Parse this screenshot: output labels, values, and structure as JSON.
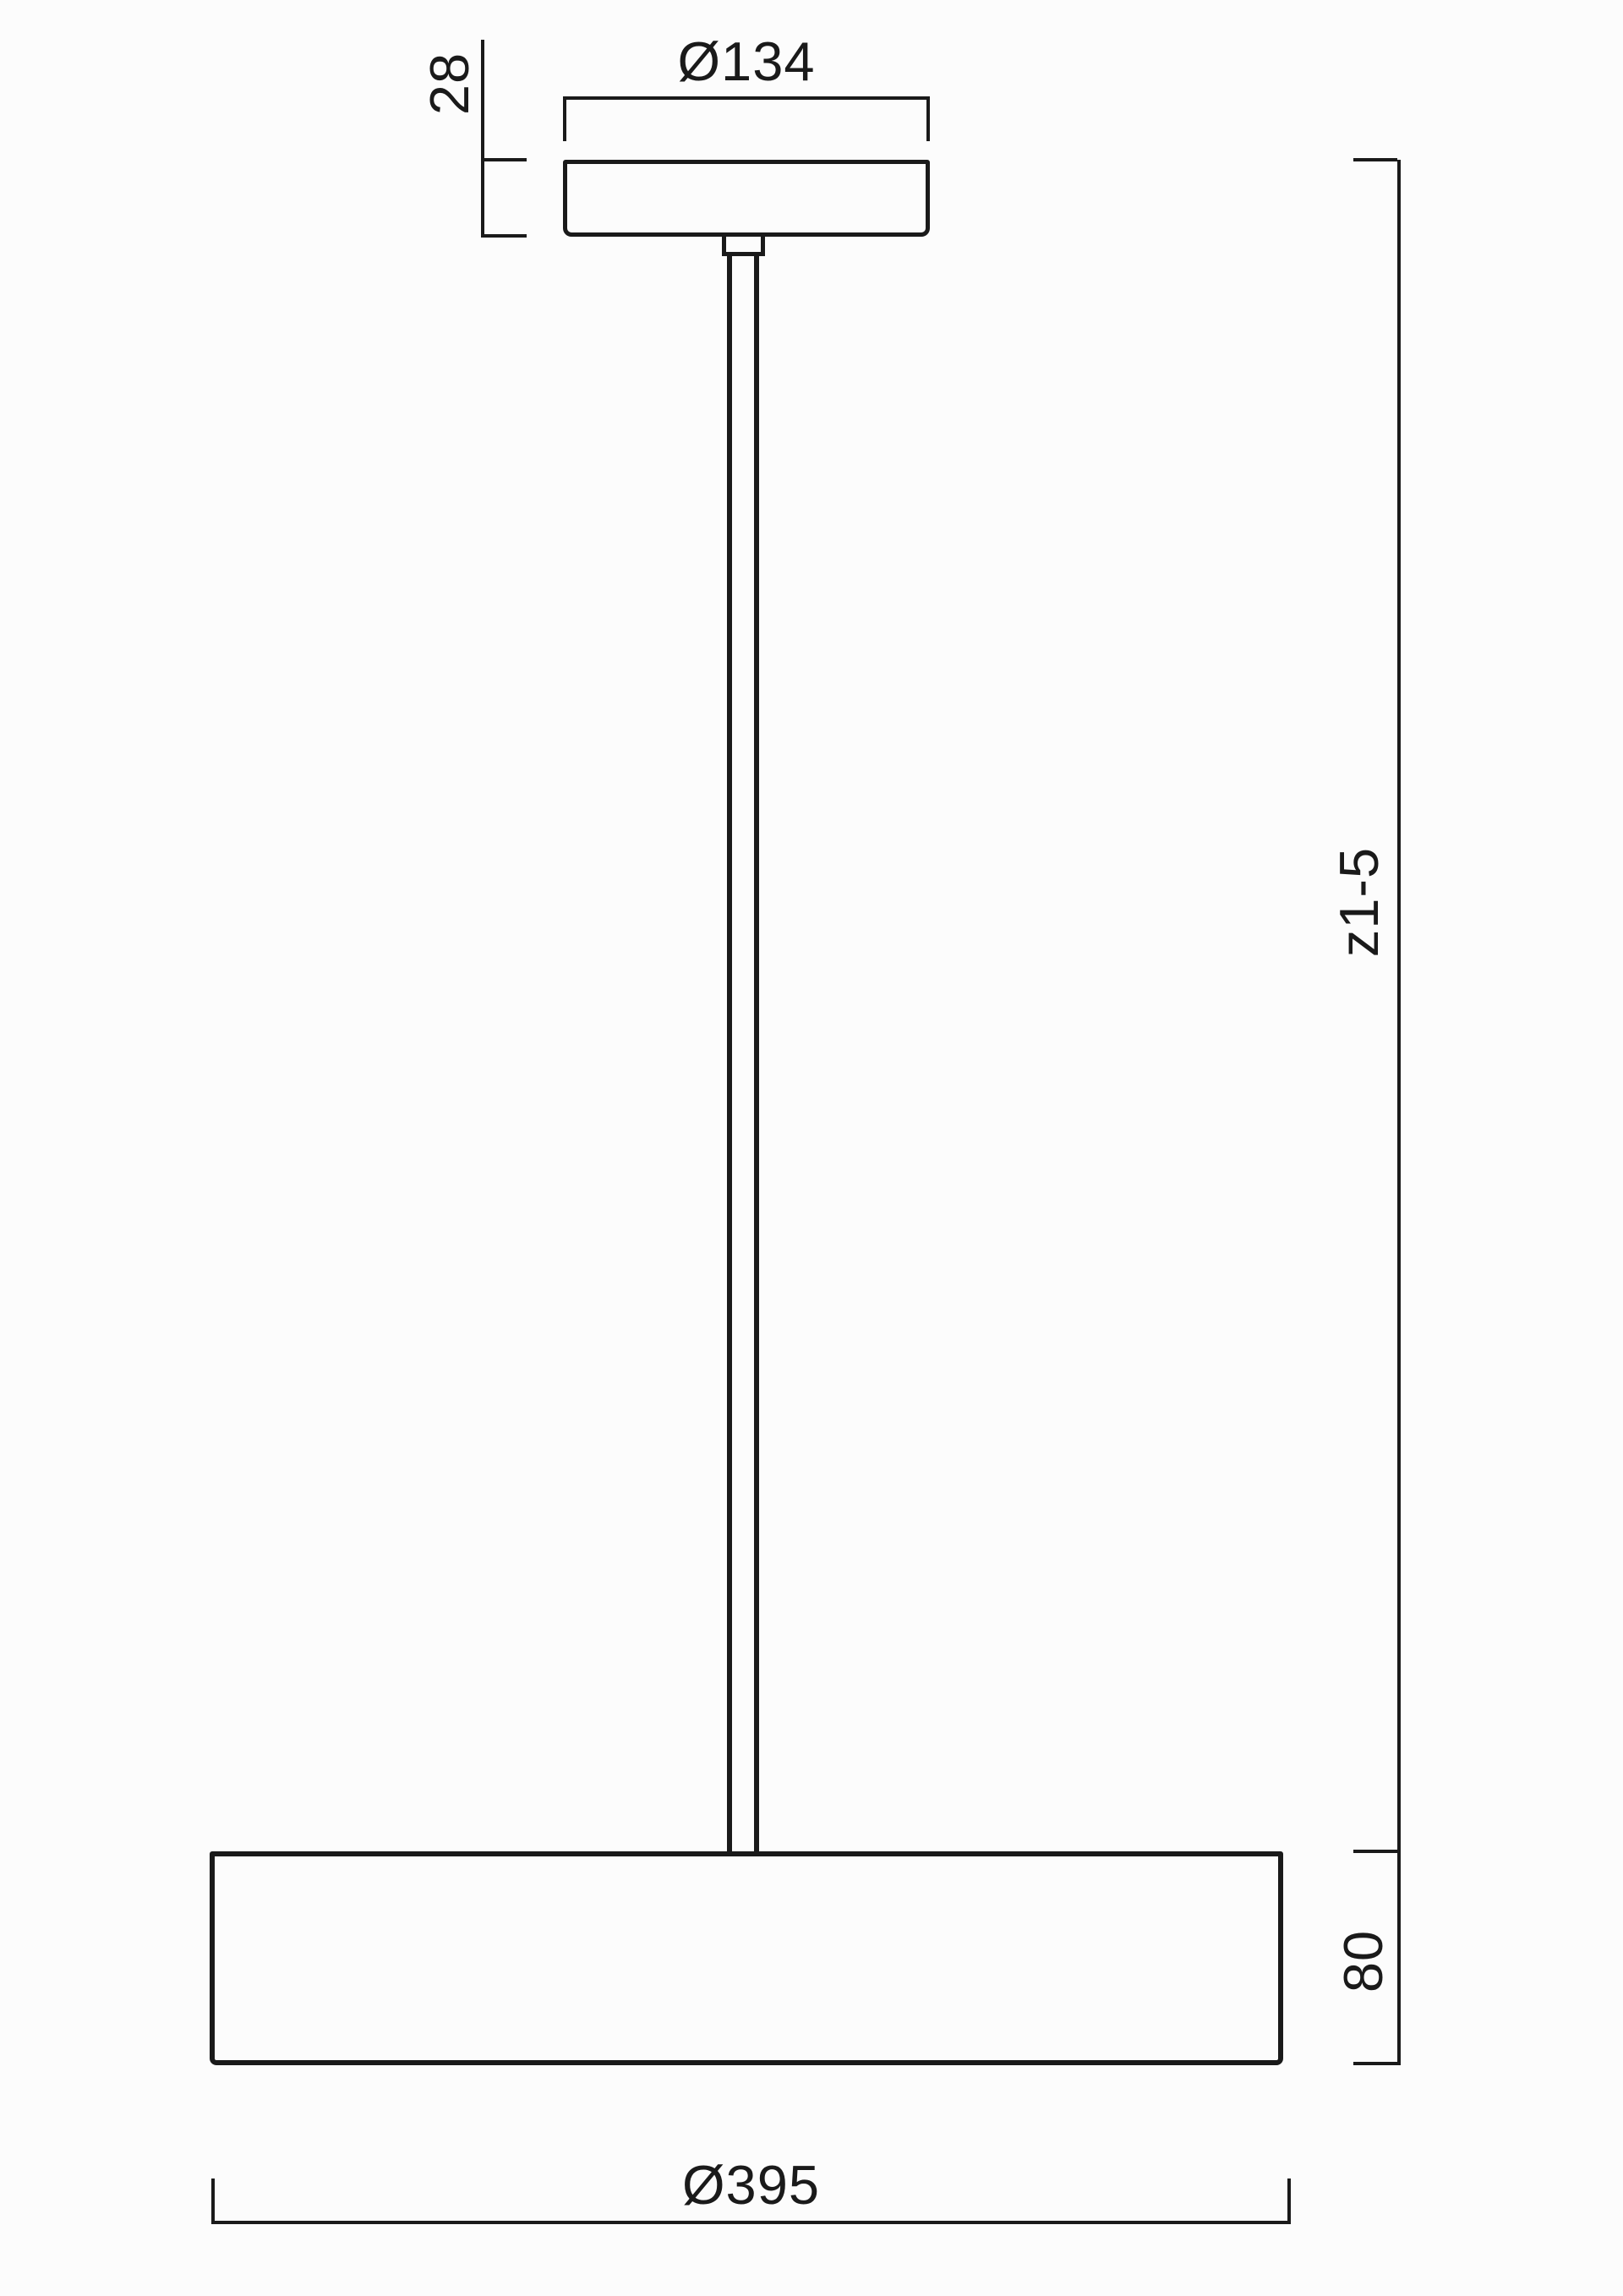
{
  "drawing": {
    "title": "pendant-luminaire-dimension-drawing",
    "background_color": "#fcfcfc",
    "line_color": "#1a1a1a",
    "labels": {
      "canopy_diameter": "Ø134",
      "canopy_height": "28",
      "pendant_length": "z1-5",
      "shade_height": "80",
      "shade_diameter": "Ø395"
    }
  }
}
